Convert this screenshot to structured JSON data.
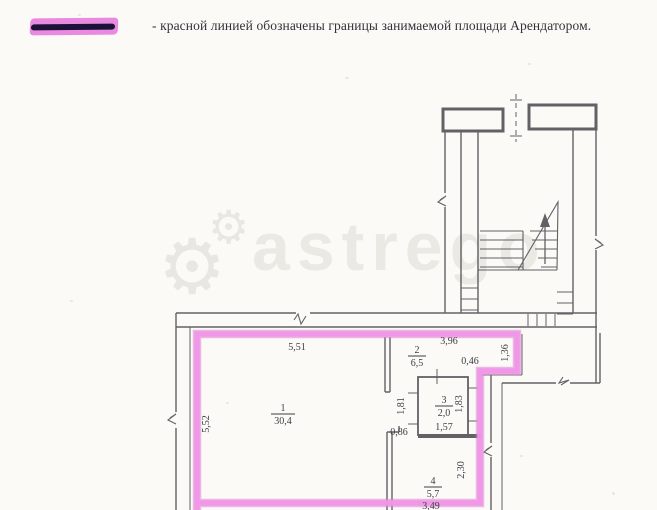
{
  "page": {
    "background": "#fbfaf6"
  },
  "legend": {
    "swatch_color": "#e98ae0",
    "swatch_line_color": "#1c1138",
    "text": "- красной линией обозначены границы занимаемой площади Арендатором."
  },
  "watermark": {
    "text": "astrego",
    "gear_icon": "⚙"
  },
  "plan": {
    "boundary_color": "#e689dd",
    "line_color": "#4d4d52",
    "rooms": [
      {
        "number": "1",
        "area": "30,4"
      },
      {
        "number": "2",
        "area": "6,5"
      },
      {
        "number": "3",
        "area": "2,0"
      },
      {
        "number": "4",
        "area": "5,7"
      }
    ],
    "dimensions": {
      "room1_top": "5,51",
      "room1_left": "5,52",
      "room2_top": "3,96",
      "notch_width": "0,46",
      "notch_height": "1,36",
      "room3_left": "1,81",
      "room3_right": "1,83",
      "room3_width": "1,57",
      "gap_width": "0,86",
      "room4_right": "2,30",
      "room4_bottom": "3,49"
    }
  }
}
